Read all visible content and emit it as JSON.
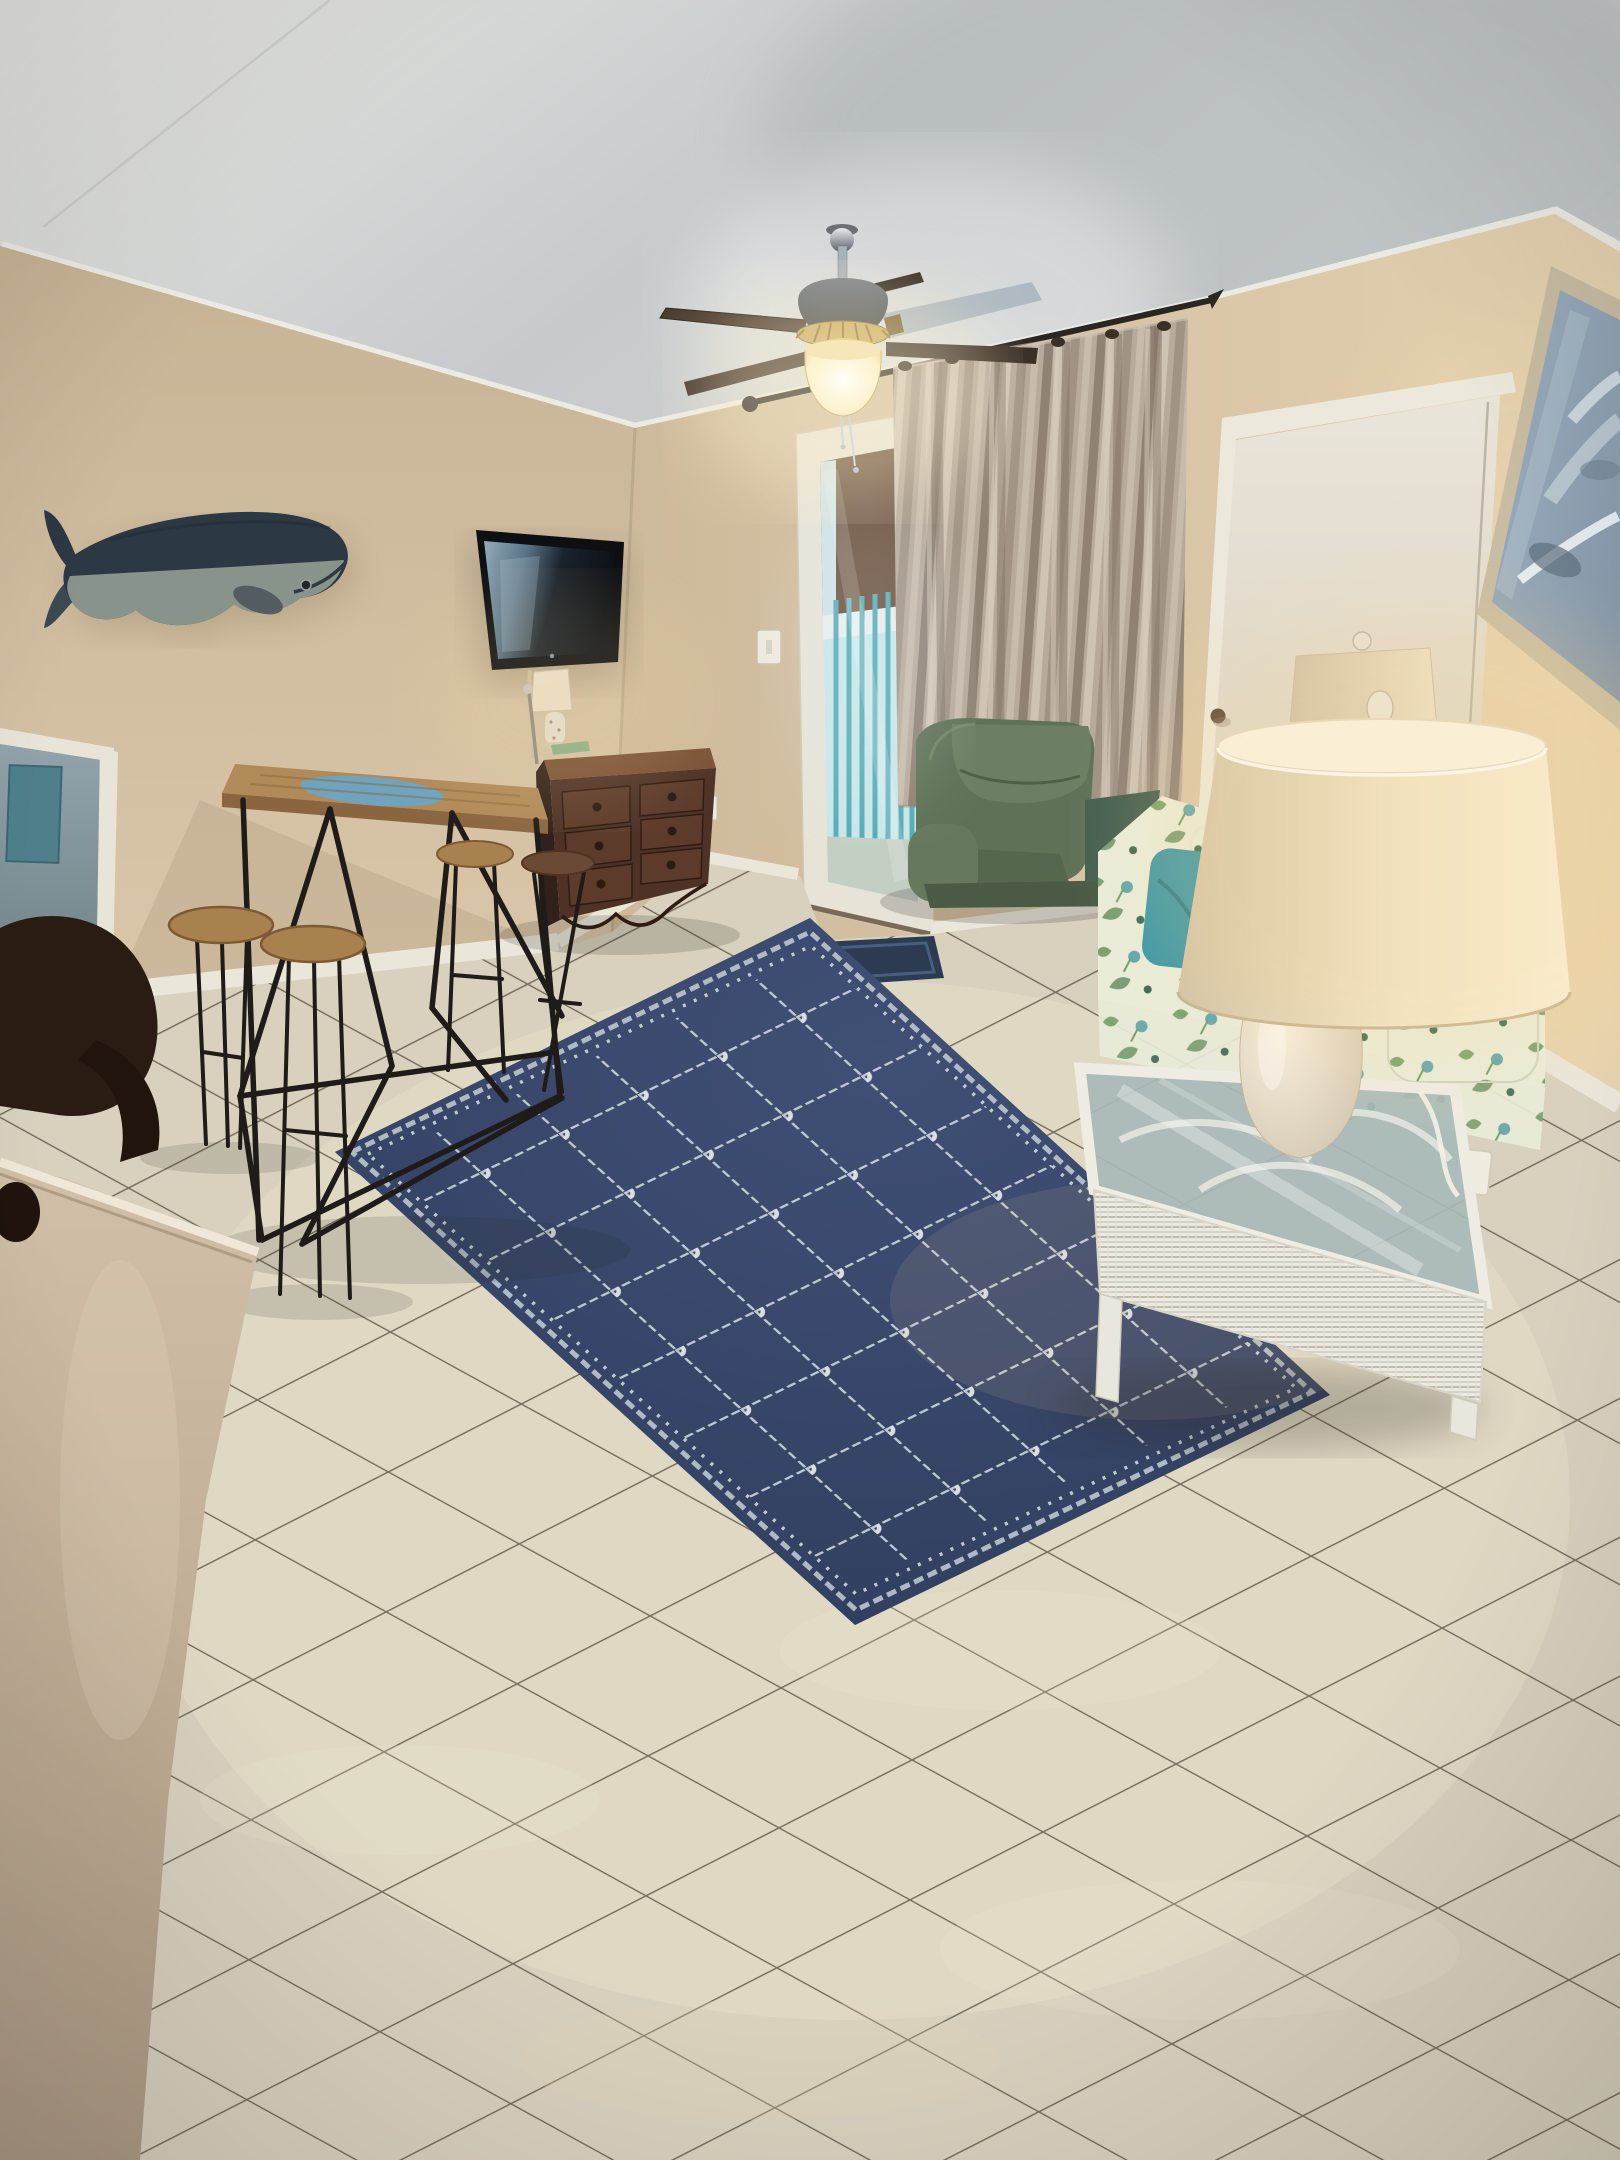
{
  "photo": {
    "scene": "Coastal condo living room with beige tile floor",
    "style": "interior real-estate photograph",
    "lighting": "warm table lamps, lit ceiling fan, daylight through balcony door"
  },
  "palette": {
    "ceiling": "#d9dad6",
    "crown": "#ecebe3",
    "wall_left": "#d3c0a4",
    "wall_front": "#d8c5a8",
    "baseboard": "#eae6da",
    "tile": "#d8d1be",
    "grout": "#5c5343",
    "rug": "#36456a",
    "rug_rope": "#d3dade",
    "curtain": "#b7aa9c",
    "rod": "#2b2622",
    "door_trim": "#ece8dc",
    "closet_door": "#e2ddd0",
    "balcony_teal": "#5fb4bd",
    "balcony_sky": "#c8e6ea",
    "building": "#6d5340",
    "mat": "#2c3a52",
    "whale_back": "#2d3845",
    "whale_belly": "#87938b",
    "tv": "#0d0f12",
    "tv_glare": "#8fa8b8",
    "dresser": "#4e3226",
    "wood_table": "#b08a58",
    "table_inlay": "#6ba4c4",
    "metal": "#1f1b18",
    "stool_wood": "#a9814f",
    "recliner": "#5f7258",
    "sofa_base": "#e9ecda",
    "sofa_green": "#7ba36b",
    "sofa_teal": "#4c9aa6",
    "pillow": "#3e98a6",
    "wicker": "#eceae2",
    "shade": "#ecdfc4",
    "lamp_base": "#e9e0cc",
    "art_frame": "#c8bca2",
    "art_canvas": "#91a5b6",
    "fan_brass": "#c9a85c",
    "fan_motor": "#4a5055",
    "counter": "#c9b69e",
    "chair_dark": "#2a1c13"
  },
  "objects": [
    {
      "id": "ceiling-fan",
      "label": "Ceiling fan with light"
    },
    {
      "id": "whale-art",
      "label": "Wooden whale wall art"
    },
    {
      "id": "tv",
      "label": "Wall-mounted flat screen TV"
    },
    {
      "id": "dresser",
      "label": "Dark wood six-drawer dresser"
    },
    {
      "id": "accent-lamp",
      "label": "Small shell accent lamp"
    },
    {
      "id": "bar-table",
      "label": "High-top wood table with black metal truss base"
    },
    {
      "id": "stools",
      "label": "Round wooden bar stools"
    },
    {
      "id": "balcony-door",
      "label": "Glass balcony door with balcony view"
    },
    {
      "id": "curtains",
      "label": "Greige grommet curtain panels"
    },
    {
      "id": "recliner",
      "label": "Sage green recliner chair"
    },
    {
      "id": "sofa",
      "label": "Tropical print sofa"
    },
    {
      "id": "teal-pillow",
      "label": "Teal throw pillow"
    },
    {
      "id": "wicker-table",
      "label": "White wicker glass-top side table"
    },
    {
      "id": "large-lamp",
      "label": "Large ceramic table lamp with drum shade"
    },
    {
      "id": "second-lamp",
      "label": "Matching second table lamp"
    },
    {
      "id": "closet-door",
      "label": "White closet door"
    },
    {
      "id": "wall-art",
      "label": "Framed abstract seascape painting"
    },
    {
      "id": "rug",
      "label": "Navy rope-trellis area rug"
    },
    {
      "id": "door-mat",
      "label": "Navy entry mat"
    },
    {
      "id": "tile-floor",
      "label": "Beige ceramic tile floor"
    },
    {
      "id": "doorway",
      "label": "Doorway to adjacent room"
    },
    {
      "id": "counter",
      "label": "Foreground counter edge"
    },
    {
      "id": "wood-chair",
      "label": "Dark wood chair back"
    }
  ]
}
